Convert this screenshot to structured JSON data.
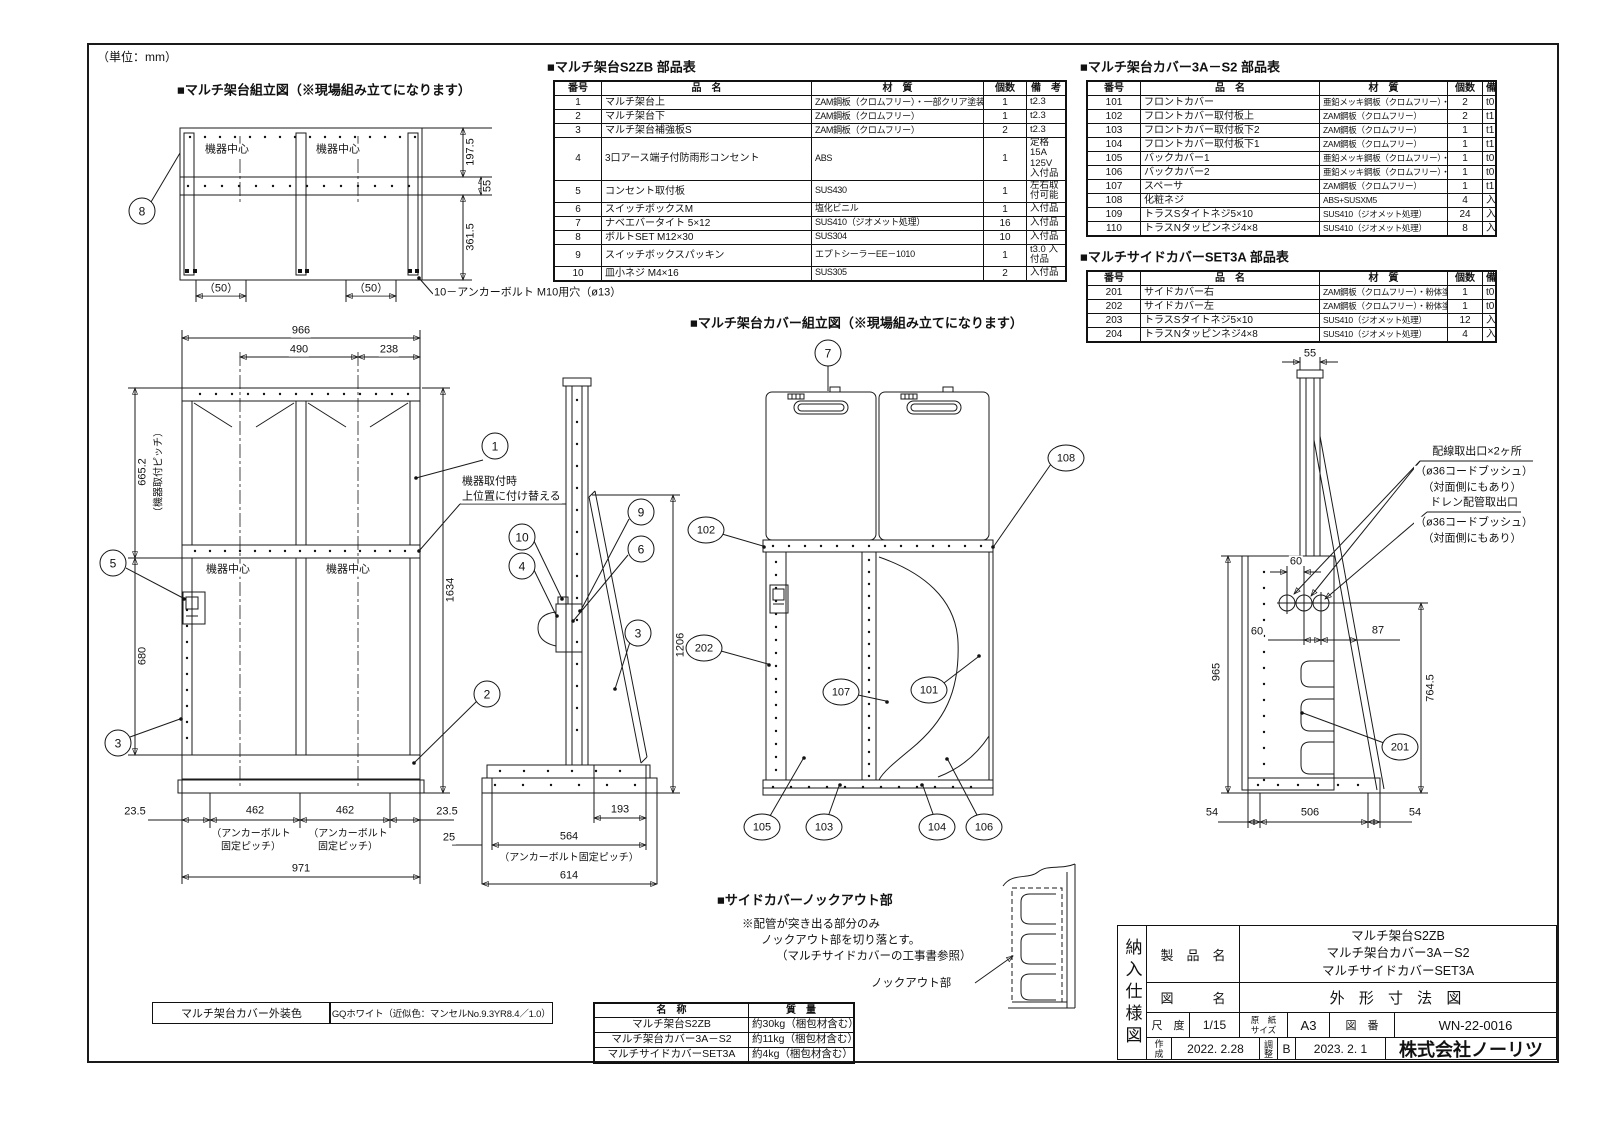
{
  "unit_note": "（単位：mm）",
  "base_view": {
    "title": "■マルチ架台組立図（※現場組み立てになります）",
    "center1": "機器中心",
    "center2": "機器中心",
    "d197": "197.5",
    "d55": "55",
    "d361": "361.5",
    "d50a": "（50）",
    "d50b": "（50）",
    "anchor_note": "10－アンカーボルト M10用穴（ø13）"
  },
  "front_view": {
    "center1": "機器中心",
    "center2": "機器中心",
    "w966": "966",
    "w490": "490",
    "w238": "238",
    "p665": "665.2",
    "p665_note": "（機器取付ピッチ）",
    "h680": "680",
    "h1634": "1634",
    "m235a": "23.5",
    "m462a": "462",
    "m462b": "462",
    "m235b": "23.5",
    "anchor_a1": "（アンカーボルト",
    "anchor_a2": "固定ピッチ）",
    "anchor_b1": "（アンカーボルト",
    "anchor_b2": "固定ピッチ）",
    "w971": "971",
    "note1": "機器取付時",
    "note2": "上位置に付け替える"
  },
  "side_view": {
    "h1206": "1206",
    "d193": "193",
    "d25a": "25",
    "d564": "564",
    "anchor": "（アンカーボルト固定ピッチ）",
    "d614": "614"
  },
  "cover_view": {
    "title": "■マルチ架台カバー組立図（※現場組み立てになります）"
  },
  "cover_side": {
    "d55": "55",
    "d60a": "60",
    "d60b": "60",
    "d87": "87",
    "d965": "965",
    "d764": "764.5",
    "d54a": "54",
    "d506": "506",
    "d54b": "54",
    "wiring1": "配線取出口×2ヶ所",
    "wiring2": "（ø36コードブッシュ）",
    "wiring3": "（対面側にもあり）",
    "drain1": "ドレン配管取出口",
    "drain2": "（ø36コードブッシュ）",
    "drain3": "（対面側にもあり）"
  },
  "knockout": {
    "title": "■サイドカバーノックアウト部",
    "note1": "※配管が突き出る部分のみ",
    "note2": "ノックアウト部を切り落とす。",
    "note3": "（マルチサイドカバーの工事書参照）",
    "label": "ノックアウト部"
  },
  "balloons": {
    "b1": "1",
    "b2": "2",
    "b3": "3",
    "b4": "4",
    "b5": "5",
    "b6": "6",
    "b7": "7",
    "b8": "8",
    "b9": "9",
    "b10": "10",
    "b101": "101",
    "b102": "102",
    "b103": "103",
    "b104": "104",
    "b105": "105",
    "b106": "106",
    "b107": "107",
    "b108": "108",
    "b201": "201",
    "b202": "202"
  },
  "tables": {
    "s2zb": {
      "title": "■マルチ架台S2ZB 部品表",
      "headers": [
        "番号",
        "品　名",
        "材　質",
        "個数",
        "備　考"
      ],
      "rows": [
        [
          "1",
          "マルチ架台上",
          "ZAM鋼板（クロムフリー）・一部クリア塗装",
          "1",
          "t2.3"
        ],
        [
          "2",
          "マルチ架台下",
          "ZAM鋼板（クロムフリー）",
          "1",
          "t2.3"
        ],
        [
          "3",
          "マルチ架台補強板S",
          "ZAM鋼板（クロムフリー）",
          "2",
          "t2.3"
        ],
        [
          "4",
          "3口アース端子付防雨形コンセント",
          "ABS",
          "1",
          "定格 15A 125V 入付品"
        ],
        [
          "5",
          "コンセント取付板",
          "SUS430",
          "1",
          "左右取付可能"
        ],
        [
          "6",
          "スイッチボックスM",
          "塩化ビニル",
          "1",
          "入付品"
        ],
        [
          "7",
          "ナベエバータイト 5×12",
          "SUS410（ジオメット処理）",
          "16",
          "入付品"
        ],
        [
          "8",
          "ボルトSET M12×30",
          "SUS304",
          "10",
          "入付品"
        ],
        [
          "9",
          "スイッチボックスパッキン",
          "エプトシーラーEE－1010",
          "1",
          "t3.0 入付品"
        ],
        [
          "10",
          "皿小ネジ M4×16",
          "SUS305",
          "2",
          "入付品"
        ]
      ]
    },
    "cover3a": {
      "title": "■マルチ架台カバー3A－S2 部品表",
      "headers": [
        "番号",
        "品　名",
        "材　質",
        "個数",
        "備 考"
      ],
      "rows": [
        [
          "101",
          "フロントカバー",
          "亜鉛メッキ鋼板（クロムフリー）・粉体塗装",
          "2",
          "t0.5"
        ],
        [
          "102",
          "フロントカバー取付板上",
          "ZAM鋼板（クロムフリー）",
          "2",
          "t1.2"
        ],
        [
          "103",
          "フロントカバー取付板下2",
          "ZAM鋼板（クロムフリー）",
          "1",
          "t1.2"
        ],
        [
          "104",
          "フロントカバー取付板下1",
          "ZAM鋼板（クロムフリー）",
          "1",
          "t1.2"
        ],
        [
          "105",
          "バックカバー1",
          "亜鉛メッキ鋼板（クロムフリー）・粉体塗装",
          "1",
          "t0.6"
        ],
        [
          "106",
          "バックカバー2",
          "亜鉛メッキ鋼板（クロムフリー）・粉体塗装",
          "1",
          "t0.6"
        ],
        [
          "107",
          "スペーサ",
          "ZAM鋼板（クロムフリー）",
          "1",
          "t1.0"
        ],
        [
          "108",
          "化粧ネジ",
          "ABS+SUSXM5",
          "4",
          "入付品"
        ],
        [
          "109",
          "トラスSタイトネジ5×10",
          "SUS410（ジオメット処理）",
          "24",
          "入付品"
        ],
        [
          "110",
          "トラスNタッピンネジ4×8",
          "SUS410（ジオメット処理）",
          "8",
          "入付品"
        ]
      ]
    },
    "set3a": {
      "title": "■マルチサイドカバーSET3A 部品表",
      "headers": [
        "番号",
        "品　名",
        "材　質",
        "個数",
        "備 考"
      ],
      "rows": [
        [
          "201",
          "サイドカバー右",
          "ZAM鋼板（クロムフリー）・粉体塗装",
          "1",
          "t0.8"
        ],
        [
          "202",
          "サイドカバー左",
          "ZAM鋼板（クロムフリー）・粉体塗装",
          "1",
          "t0.8"
        ],
        [
          "203",
          "トラスSタイトネジ5×10",
          "SUS410（ジオメット処理）",
          "12",
          "入付品"
        ],
        [
          "204",
          "トラスNタッピンネジ4×8",
          "SUS410（ジオメット処理）",
          "4",
          "入付品"
        ]
      ]
    },
    "weights": {
      "headers": [
        "名　称",
        "質　量"
      ],
      "rows": [
        [
          "マルチ架台S2ZB",
          "約30kg（梱包材含む）"
        ],
        [
          "マルチ架台カバー3A－S2",
          "約11kg（梱包材含む）"
        ],
        [
          "マルチサイドカバーSET3A",
          "約4kg（梱包材含む）"
        ]
      ]
    }
  },
  "color_note": {
    "label": "マルチ架台カバー外装色",
    "value": "GQホワイト（近似色：マンセルNo.9.3YR8.4／1.0）"
  },
  "title_block": {
    "doc_type": "納入仕様図",
    "product_label": "製　品　名",
    "products": [
      "マルチ架台S2ZB",
      "マルチ架台カバー3A－S2",
      "マルチサイドカバーSET3A"
    ],
    "drawing_label": "図　　　名",
    "drawing_title": "外 形 寸 法 図",
    "scale_label": "尺　度",
    "scale_value": "1/15",
    "paper_label_1": "原　紙",
    "paper_label_2": "サイズ",
    "paper_value": "A3",
    "dwg_no_label": "図　番",
    "dwg_no_value": "WN-22-0016",
    "created_label": "作成",
    "created_date": "2022. 2.28",
    "revised_label": "調整",
    "revision": "B",
    "revised_date": "2023. 2. 1",
    "company": "株式会社ノーリツ"
  }
}
